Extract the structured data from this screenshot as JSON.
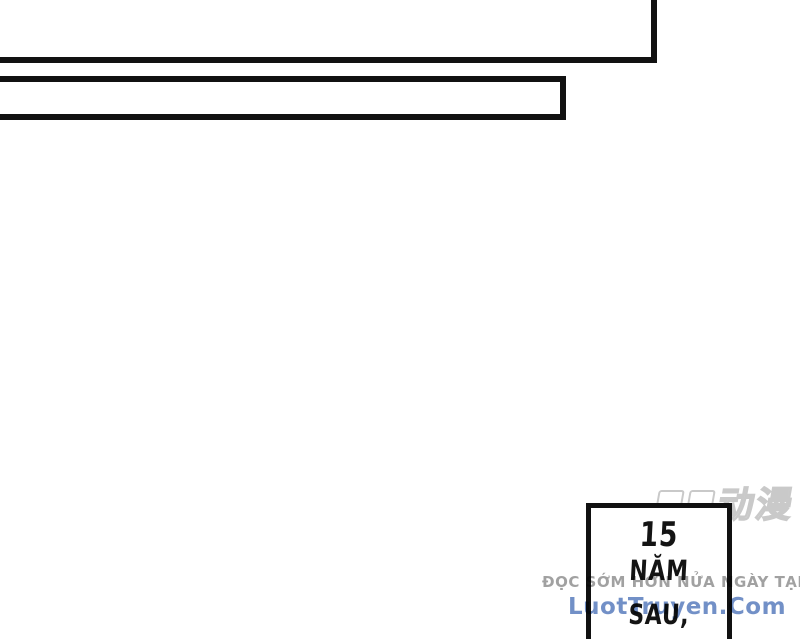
{
  "caption": {
    "lines": [
      "15",
      "NĂM",
      "SAU,"
    ]
  },
  "watermark": {
    "promo": "ĐỌC SỚM HƠN NỬA NGÀY TẠI",
    "promo_color": "#949494",
    "site": "LuotTruyen.Com",
    "site_color": "#6687c2"
  },
  "corner_logo": {
    "visible_text": "动漫",
    "stroke_color": "#c9c9c9"
  },
  "colors": {
    "page_bg": "#ffffff",
    "panel_border": "#111111",
    "caption_text": "#141414"
  }
}
